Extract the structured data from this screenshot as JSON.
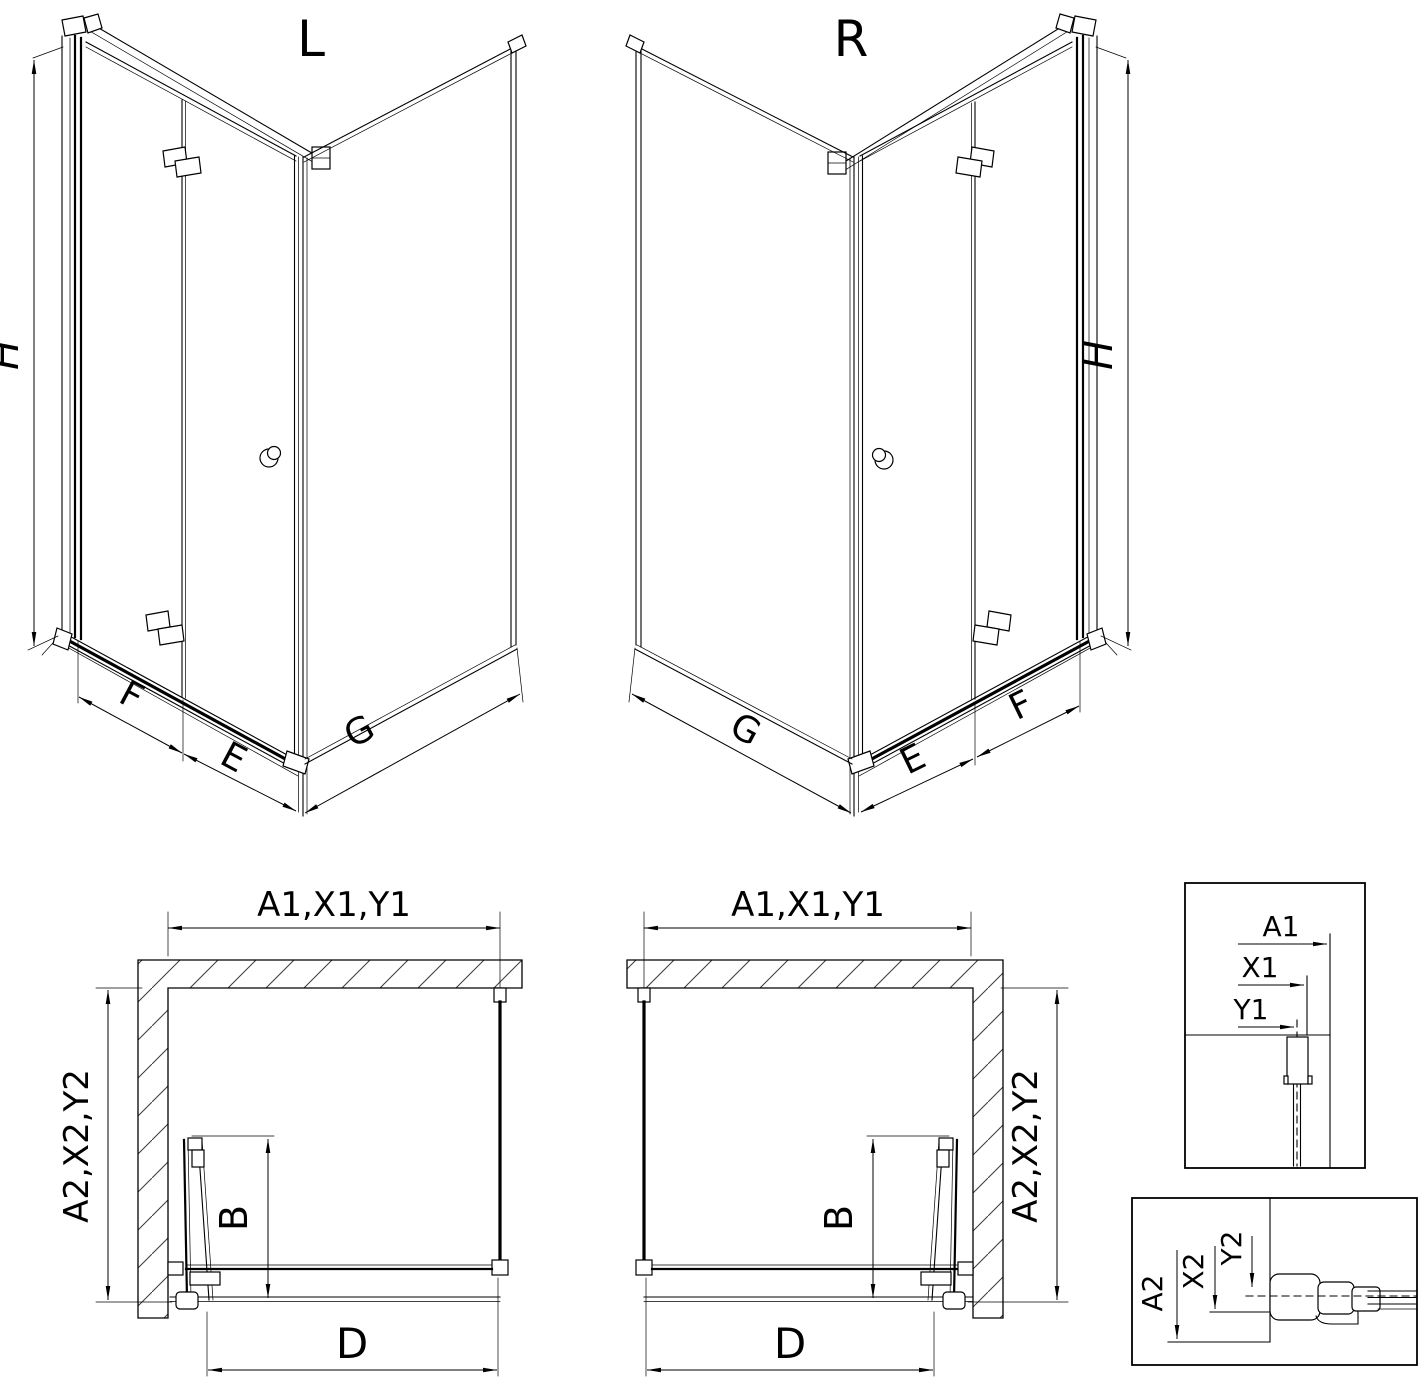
{
  "drawing": {
    "type": "shower-enclosure-technical-drawing",
    "background": "#ffffff",
    "line_color": "#000000",
    "hatch_color": "#3a3a3a",
    "views": {
      "iso_left": {
        "variant": "L",
        "dim_height": "H",
        "dim_door_width": "F",
        "dim_entry_width": "E",
        "dim_side_width": "G"
      },
      "iso_right": {
        "variant": "R",
        "dim_height": "H",
        "dim_door_width": "F",
        "dim_entry_width": "E",
        "dim_side_width": "G"
      },
      "plan_left": {
        "dim_top": "A1,X1,Y1",
        "dim_side": "A2,X2,Y2",
        "dim_fold": "B",
        "dim_opening": "D"
      },
      "plan_right": {
        "dim_top": "A1,X1,Y1",
        "dim_side": "A2,X2,Y2",
        "dim_fold": "B",
        "dim_opening": "D"
      },
      "detail_top": {
        "dim_a": "A1",
        "dim_x": "X1",
        "dim_y": "Y1"
      },
      "detail_bottom": {
        "dim_a": "A2",
        "dim_x": "X2",
        "dim_y": "Y2"
      }
    }
  }
}
